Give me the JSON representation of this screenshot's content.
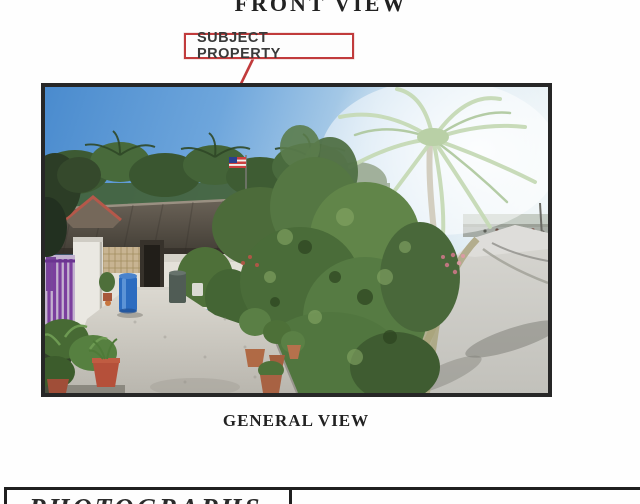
{
  "document": {
    "front_view_label": "FRONT VIEW",
    "general_view_label": "GENERAL VIEW",
    "photographs_label": "PHOTOGRAPHS"
  },
  "callout": {
    "label": "SUBJECT PROPERTY"
  },
  "photo": {
    "caption": "GENERAL VIEW",
    "alt": "Single-storey house with dark corrugated roof, blue barrel, purple gate, concrete driveway, potted plants, palm trees and curving access road",
    "elements": [
      "sky",
      "background-palm-trees",
      "malaysian-flag",
      "large-palm-tree",
      "house-roof",
      "house-front",
      "purple-gate",
      "blue-barrel",
      "driveway",
      "garden-bushes",
      "potted-plants",
      "access-road"
    ]
  },
  "colors": {
    "accent_red": "#c13b3c",
    "text_dark": "#2e2e2e",
    "frame_border": "#272727",
    "table_line": "#1f1f1f"
  }
}
